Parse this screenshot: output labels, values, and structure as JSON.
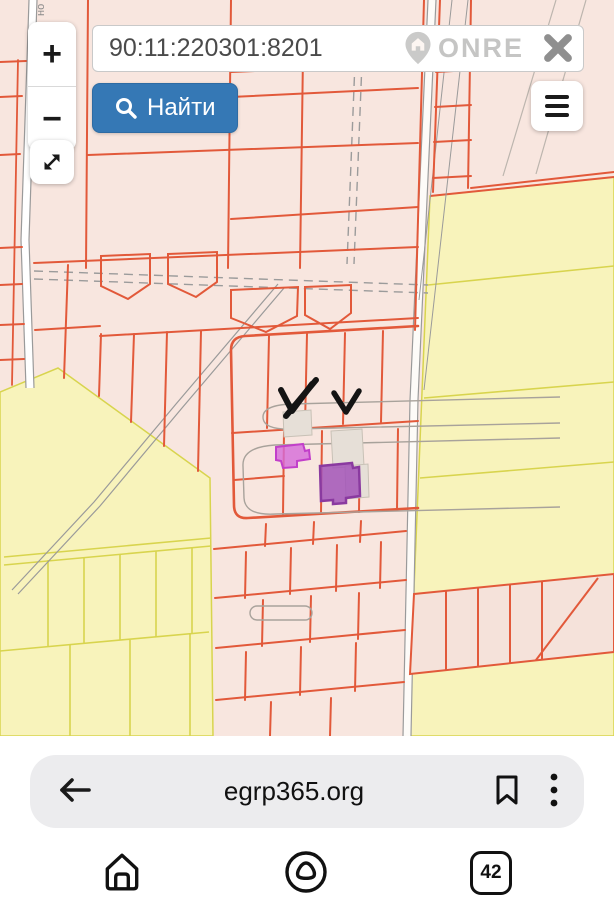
{
  "search": {
    "value": "90:11:220301:8201",
    "find_label": "Найти"
  },
  "map_controls": {
    "zoom_in_label": "+",
    "zoom_out_label": "−"
  },
  "watermark": {
    "brand": "ONRE"
  },
  "map": {
    "street_label": "но",
    "colors": {
      "parcel_pink_fill": "#f8e6df",
      "parcel_border_red": "#e2593a",
      "land_yellow_fill": "#f8f3bb",
      "land_yellow_border": "#d8d44e",
      "road_gray": "#9a9a9a",
      "building_gray": "#e6dfd7",
      "highlight_magenta": "#d46ad8",
      "highlight_purple": "#a254b8",
      "annotation_black": "#141414",
      "find_button_blue": "#3578b5"
    }
  },
  "browser": {
    "url": "egrp365.org",
    "tab_count": "42"
  }
}
